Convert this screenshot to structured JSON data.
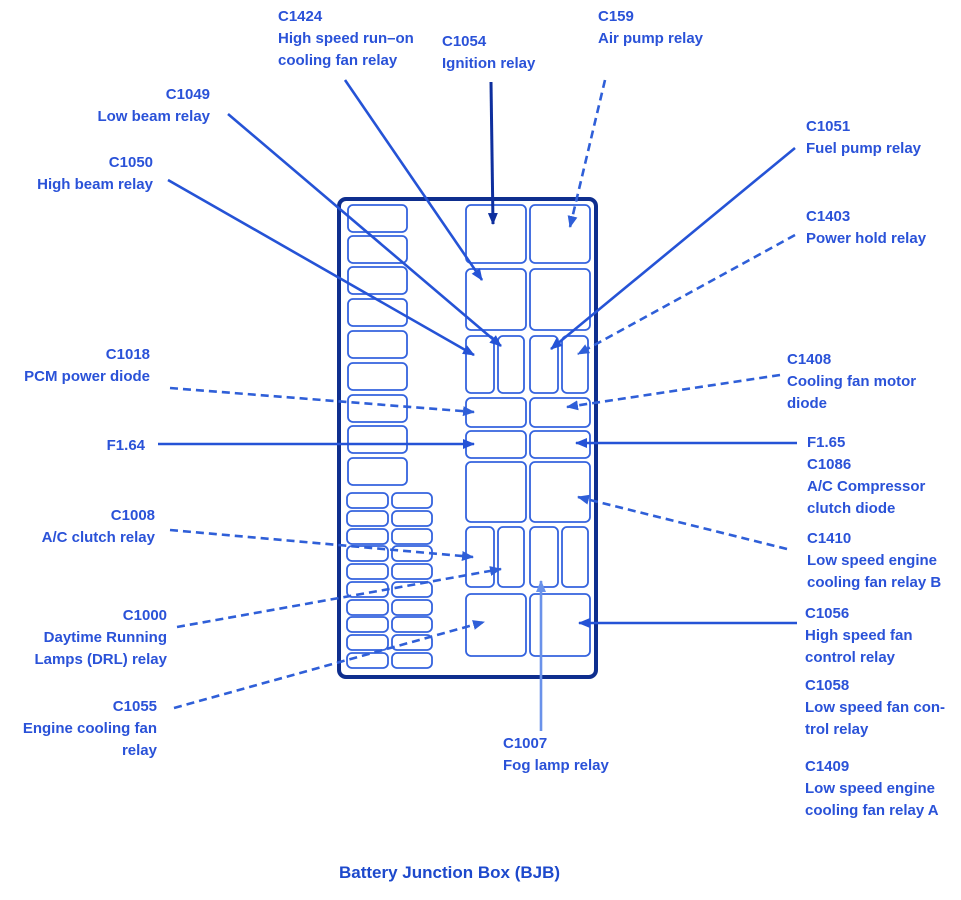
{
  "caption": "Battery Junction Box (BJB)",
  "colors": {
    "background": "#ffffff",
    "label_text": "#2a52d8",
    "caption_text": "#1d49cc",
    "line_blue": "#2553d6",
    "dashed_blue": "#2f5fd8",
    "dark_navy": "#0e2f9e",
    "light_blue": "#6a92ea",
    "box_stroke": "#3463de",
    "outer_border": "#0e2e8e"
  },
  "labels": {
    "c1424": {
      "lines": [
        "C1424",
        "High speed run–on",
        "cooling fan relay"
      ]
    },
    "c1054": {
      "lines": [
        "C1054",
        "Ignition relay"
      ]
    },
    "c159": {
      "lines": [
        "C159",
        "Air pump relay"
      ]
    },
    "c1049": {
      "lines": [
        "C1049",
        "Low beam relay"
      ]
    },
    "c1050": {
      "lines": [
        "C1050",
        "High beam relay"
      ]
    },
    "c1051": {
      "lines": [
        "C1051",
        "Fuel pump relay"
      ]
    },
    "c1403": {
      "lines": [
        "C1403",
        "Power hold relay"
      ]
    },
    "c1018": {
      "lines": [
        "C1018",
        "PCM power diode"
      ]
    },
    "f164": {
      "lines": [
        "F1.64"
      ]
    },
    "c1408": {
      "lines": [
        "C1408",
        "Cooling fan motor",
        "diode"
      ]
    },
    "f165": {
      "lines": [
        "F1.65"
      ]
    },
    "c1086": {
      "lines": [
        "C1086",
        "A/C Compressor",
        "clutch diode"
      ]
    },
    "c1410": {
      "lines": [
        "C1410",
        "Low speed engine",
        "cooling fan relay B"
      ]
    },
    "c1008": {
      "lines": [
        "C1008",
        "A/C clutch relay"
      ]
    },
    "c1000": {
      "lines": [
        "C1000",
        "Daytime Running",
        "Lamps (DRL) relay"
      ]
    },
    "c1055": {
      "lines": [
        "C1055",
        "Engine cooling fan",
        "relay"
      ]
    },
    "c1056": {
      "lines": [
        "C1056",
        "High speed fan",
        "control relay"
      ]
    },
    "c1058": {
      "lines": [
        "C1058",
        "Low speed fan con-",
        "trol relay"
      ]
    },
    "c1409": {
      "lines": [
        "C1409",
        "Low speed engine",
        "cooling fan relay A"
      ]
    },
    "c1007": {
      "lines": [
        "C1007",
        "Fog lamp relay"
      ]
    }
  }
}
